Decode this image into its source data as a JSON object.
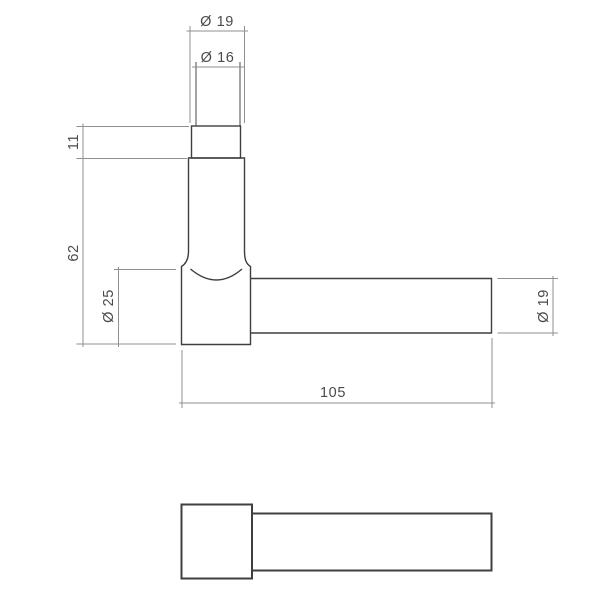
{
  "drawing": {
    "type": "technical-drawing",
    "subject": "Door lever handle, two orthographic views with dimensions",
    "views": {
      "front_view": "L-shaped lever handle front elevation",
      "side_view": "Lever handle profile view"
    },
    "dimension_labels": {
      "spindle_outer_diameter": "Ø 19",
      "spindle_inner_diameter": "Ø 16",
      "collar_height": "11",
      "post_height": "62",
      "rose_diameter": "Ø 25",
      "lever_length": "105",
      "grip_diameter": "Ø 19"
    },
    "colors": {
      "outline": "#3f3f3f",
      "dimension_line": "#8f8f8f",
      "label_text": "#4a4a4a",
      "background": "#ffffff"
    }
  }
}
